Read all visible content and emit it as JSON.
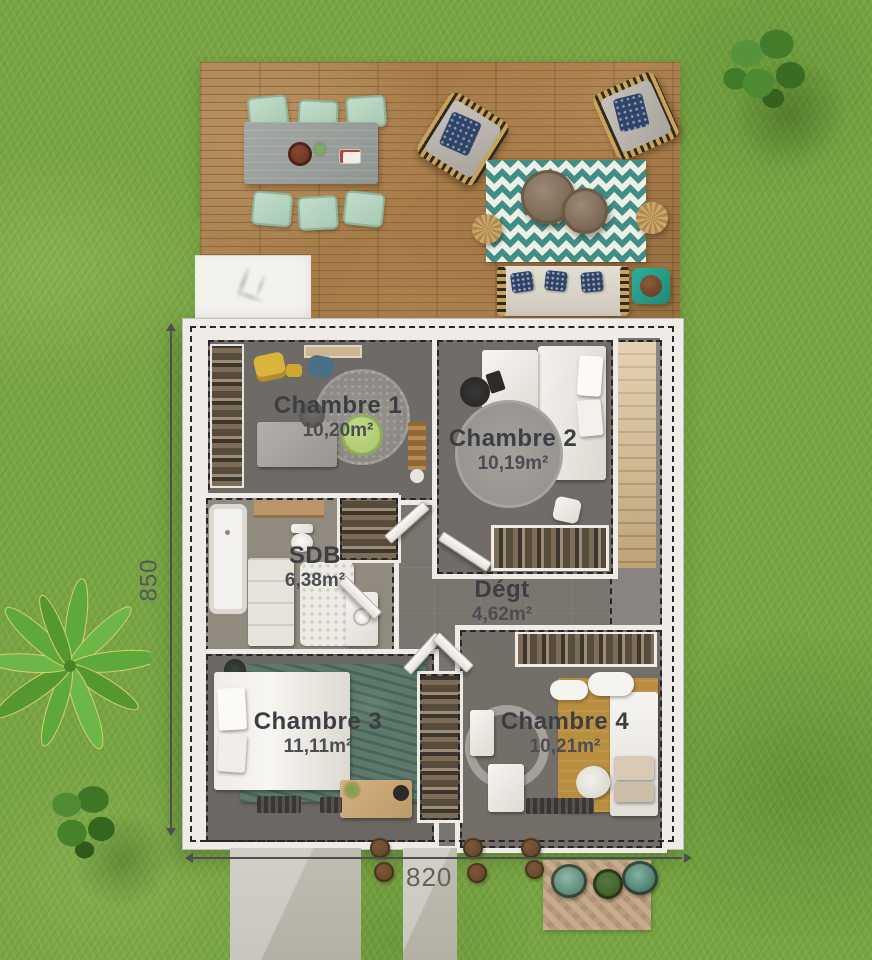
{
  "plan": {
    "rooms": [
      {
        "name": "Chambre 1",
        "area": "10,20m²"
      },
      {
        "name": "Chambre 2",
        "area": "10,19m²"
      },
      {
        "name": "SDB",
        "area": "6,38m²"
      },
      {
        "name": "Dégt",
        "area": "4,62m²"
      },
      {
        "name": "Chambre 3",
        "area": "11,11m²"
      },
      {
        "name": "Chambre 4",
        "area": "10,21m²"
      }
    ],
    "dimensions": {
      "left": "850",
      "bottom": "820"
    },
    "colors": {
      "grass": "#78a443",
      "deck_wood": "#a97f4e",
      "wall_white": "#efece7",
      "floor_dark_gray": "#6e6a65",
      "hall_gray": "#7b7570",
      "rug_teal": "#418e87",
      "rug_green": "#5c796b",
      "rug_mustard": "#b98e3f",
      "label_text": "#3c3e44",
      "dimension_text": "#55565a",
      "accent_teal_table": "#2fae97"
    }
  }
}
